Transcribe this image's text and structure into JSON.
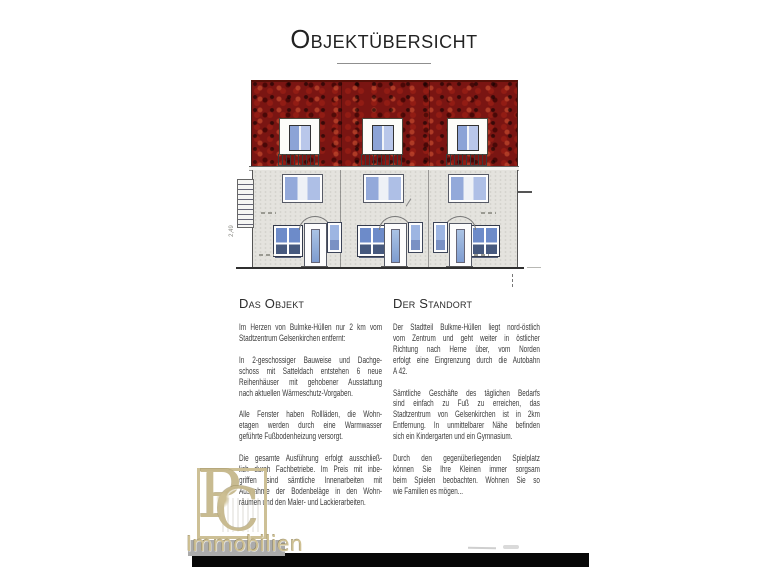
{
  "page": {
    "title": "Objektübersicht"
  },
  "colors": {
    "roof": "#7a1512",
    "facade": "#e4e3de",
    "glass": "#8ca6d9",
    "ink": "#3a3a3a",
    "watermark": "#c6b88c"
  },
  "drawing": {
    "subject": "front elevation of 3-section terraced houses with red tiled roof and dormers",
    "houses": 3,
    "dimension_note": "2,49"
  },
  "columns": {
    "left": {
      "heading": "Das Objekt",
      "paragraphs": [
        [
          "Im Herzen von Bulmke-Hüllen nur 2 km vom",
          "Stadtzentrum Gelsenkirchen entfernt:"
        ],
        [
          "In 2-geschossiger Bauweise und Dachge-",
          "schoss mit Satteldach entstehen 6 neue",
          "Reihenhäuser mit gehobener Ausstattung",
          "nach aktuellen Wärmeschutz-Vorgaben."
        ],
        [
          "Alle Fenster haben Rollläden, die Wohn-",
          "etagen werden durch eine Warmwasser",
          "geführte Fußbodenheizung versorgt."
        ],
        [
          "Die gesamte Ausführung erfolgt ausschließ-",
          "lich durch Fachbetriebe. Im Preis mit inbe-",
          "griffen sind sämtliche Innenarbeiten mit",
          "Ausnahme der Bodenbeläge in den Wohn-",
          "räumen und den Maler- und Lackierarbeiten."
        ]
      ]
    },
    "right": {
      "heading": "Der Standort",
      "paragraphs": [
        [
          "Der Stadtteil Bulkme-Hüllen liegt nord-östlich",
          "vom Zentrum und geht weiter in östlicher",
          "Richtung nach Herne über, vom Norden",
          "erfolgt eine Eingrenzung durch die Autobahn",
          "A 42."
        ],
        [
          "Sämtliche Geschäfte des täglichen Bedarfs",
          "sind einfach zu Fuß zu erreichen, das",
          "Stadtzentrum von Gelsenkirchen ist in 2km",
          "Entfernung. In unmittelbarer Nähe befinden",
          "sich ein Kindergarten und ein Gymnasium."
        ],
        [
          "Durch den gegenüberliegenden Spielplatz",
          "können Sie Ihre Kleinen immer sorgsam",
          "beim Spielen beobachten. Wohnen Sie so",
          "wie Familien es mögen..."
        ]
      ]
    }
  },
  "watermark": {
    "monogram_left": "P",
    "monogram_right": "C",
    "wordmark": "Immobilien"
  }
}
